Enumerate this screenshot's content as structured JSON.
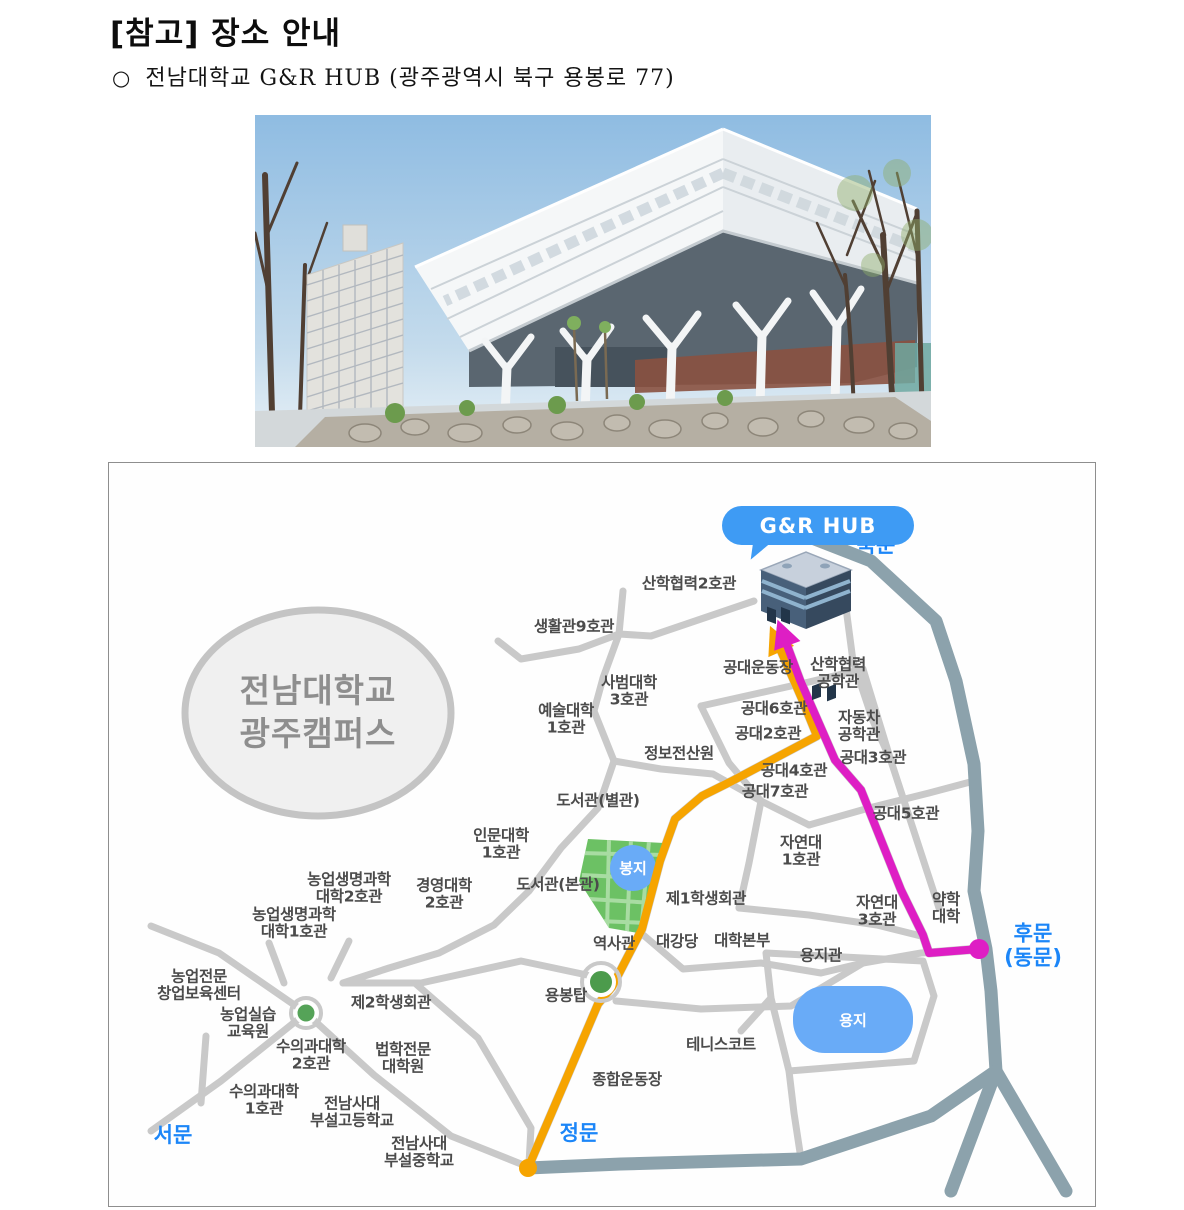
{
  "page": {
    "title": "[참고] 장소 안내",
    "bullet_marker": "○",
    "bullet_text": "전남대학교 G&R HUB (광주광역시 북구 용봉로 77)"
  },
  "map": {
    "campus_circle_label": "전남대학교\n광주캠퍼스",
    "hub_bubble_label": "G&R HUB",
    "gates": [
      {
        "text": "북문",
        "x": 767,
        "y": 83
      },
      {
        "text": "후문\n(동문)",
        "x": 924,
        "y": 483
      },
      {
        "text": "정문",
        "x": 470,
        "y": 671
      },
      {
        "text": "서문",
        "x": 64,
        "y": 673
      }
    ],
    "ponds": [
      {
        "text": "봉지",
        "x": 524,
        "y": 405
      },
      {
        "text": "용지",
        "x": 744,
        "y": 557
      }
    ],
    "landmarks": [
      {
        "text": "산학협력2호관",
        "x": 580,
        "y": 121
      },
      {
        "text": "생활관9호관",
        "x": 465,
        "y": 164
      },
      {
        "text": "공대운동장",
        "x": 649,
        "y": 205
      },
      {
        "text": "산학협력\n공학관",
        "x": 729,
        "y": 211
      },
      {
        "text": "사범대학\n3호관",
        "x": 520,
        "y": 229
      },
      {
        "text": "예술대학\n1호관",
        "x": 457,
        "y": 257
      },
      {
        "text": "자동차\n공학관",
        "x": 750,
        "y": 264
      },
      {
        "text": "공대6호관",
        "x": 665,
        "y": 246
      },
      {
        "text": "공대2호관",
        "x": 659,
        "y": 271
      },
      {
        "text": "공대3호관",
        "x": 764,
        "y": 295
      },
      {
        "text": "정보전산원",
        "x": 570,
        "y": 291
      },
      {
        "text": "공대4호관",
        "x": 685,
        "y": 308
      },
      {
        "text": "공대7호관",
        "x": 666,
        "y": 329
      },
      {
        "text": "공대5호관",
        "x": 797,
        "y": 351
      },
      {
        "text": "도서관(별관)",
        "x": 489,
        "y": 338
      },
      {
        "text": "자연대\n1호관",
        "x": 692,
        "y": 389
      },
      {
        "text": "인문대학\n1호관",
        "x": 392,
        "y": 382
      },
      {
        "text": "도서관(본관)",
        "x": 449,
        "y": 422
      },
      {
        "text": "제1학생회관",
        "x": 597,
        "y": 436
      },
      {
        "text": "경영대학\n2호관",
        "x": 335,
        "y": 432
      },
      {
        "text": "농업생명과학\n대학2호관",
        "x": 240,
        "y": 426
      },
      {
        "text": "농업생명과학\n대학1호관",
        "x": 185,
        "y": 461
      },
      {
        "text": "자연대\n3호관",
        "x": 768,
        "y": 449
      },
      {
        "text": "약학\n대학",
        "x": 837,
        "y": 446
      },
      {
        "text": "역사관",
        "x": 505,
        "y": 481
      },
      {
        "text": "대강당",
        "x": 568,
        "y": 479
      },
      {
        "text": "대학본부",
        "x": 633,
        "y": 478
      },
      {
        "text": "용지관",
        "x": 712,
        "y": 493
      },
      {
        "text": "농업전문\n창업보육센터",
        "x": 90,
        "y": 523
      },
      {
        "text": "제2학생회관",
        "x": 282,
        "y": 540
      },
      {
        "text": "용봉탑",
        "x": 457,
        "y": 533
      },
      {
        "text": "농업실습\n교육원",
        "x": 139,
        "y": 561
      },
      {
        "text": "수의과대학\n2호관",
        "x": 202,
        "y": 593
      },
      {
        "text": "법학전문\n대학원",
        "x": 294,
        "y": 596
      },
      {
        "text": "테니스코트",
        "x": 612,
        "y": 582
      },
      {
        "text": "수의과대학\n1호관",
        "x": 155,
        "y": 638
      },
      {
        "text": "전남사대\n부설고등학교",
        "x": 243,
        "y": 650
      },
      {
        "text": "종합운동장",
        "x": 518,
        "y": 617
      },
      {
        "text": "전남사대\n부설중학교",
        "x": 310,
        "y": 690
      }
    ],
    "colors": {
      "route_main": "#f6a400",
      "route_back": "#de1ec4",
      "boundary_road": "#8ca2ac",
      "road": "#c9c9c9",
      "gate_text": "#1c86f8",
      "bubble": "#3e9bf4",
      "pond": "#69abf7",
      "park": "#6cc164",
      "label_text": "#4b4b4b"
    }
  }
}
